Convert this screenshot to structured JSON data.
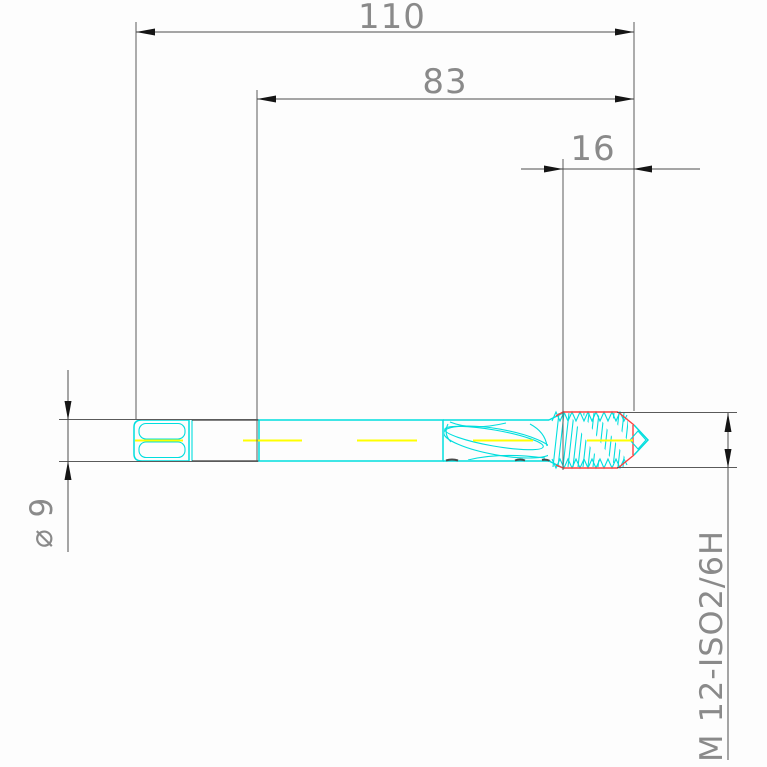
{
  "page": {
    "background": "#fdfdfd",
    "description": "CAD technical drawing of a spiral-flute machine tap, side view, with dimensions"
  },
  "drawing": {
    "dimensions": {
      "overall_length": {
        "label": "110",
        "value": 110,
        "unit": "mm",
        "orientation": "horizontal"
      },
      "front_length": {
        "label": "83",
        "value": 83,
        "unit": "mm",
        "orientation": "horizontal"
      },
      "thread_length": {
        "label": "16",
        "value": 16,
        "unit": "mm",
        "orientation": "horizontal"
      },
      "shank_diameter": {
        "label": "⌀ 9",
        "value": 9,
        "unit": "mm",
        "orientation": "vertical-rotated"
      },
      "thread_spec": {
        "label": "M 12-ISO2/6H",
        "orientation": "vertical-rotated"
      }
    },
    "colors": {
      "tool_outline": "#00dede",
      "centerline": "#ffff00",
      "thread_highlight": "#ff4040",
      "dimension_lines": "#4d4d4d",
      "dimension_text": "#8a8a8a",
      "dark_edges": "#3a3a3a"
    }
  }
}
